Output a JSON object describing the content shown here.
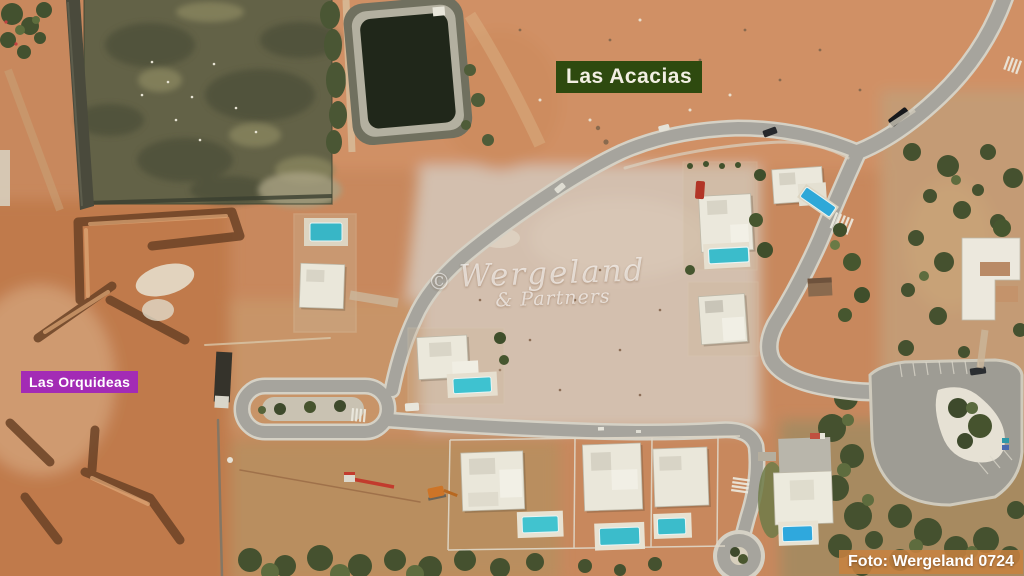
{
  "photo": {
    "labels": {
      "las_acacias": {
        "text": "Las Acacias",
        "bg": "#2e4a0f",
        "fg": "#f2efe3"
      },
      "las_orquideas": {
        "text": "Las Orquideas",
        "bg": "#a32bb5",
        "fg": "#ffffff"
      },
      "credit": {
        "text": "Foto: Wergeland 0724",
        "bg": "rgba(200,129,63,0.85)",
        "fg": "#ffffff"
      }
    },
    "watermark": {
      "copyright_symbol": "©",
      "name": "Wergeland",
      "suffix": "& Partners"
    },
    "palette": {
      "terrain": "#c8885d",
      "terrain_light": "#d5bda9",
      "field_green": "#636247",
      "road_asphalt": "#a6a49d",
      "pool_teal": "#3bbccb",
      "scrub_green": "#4a5533",
      "villa_white": "#ebe8dc",
      "pond_water": "#20271a"
    }
  }
}
